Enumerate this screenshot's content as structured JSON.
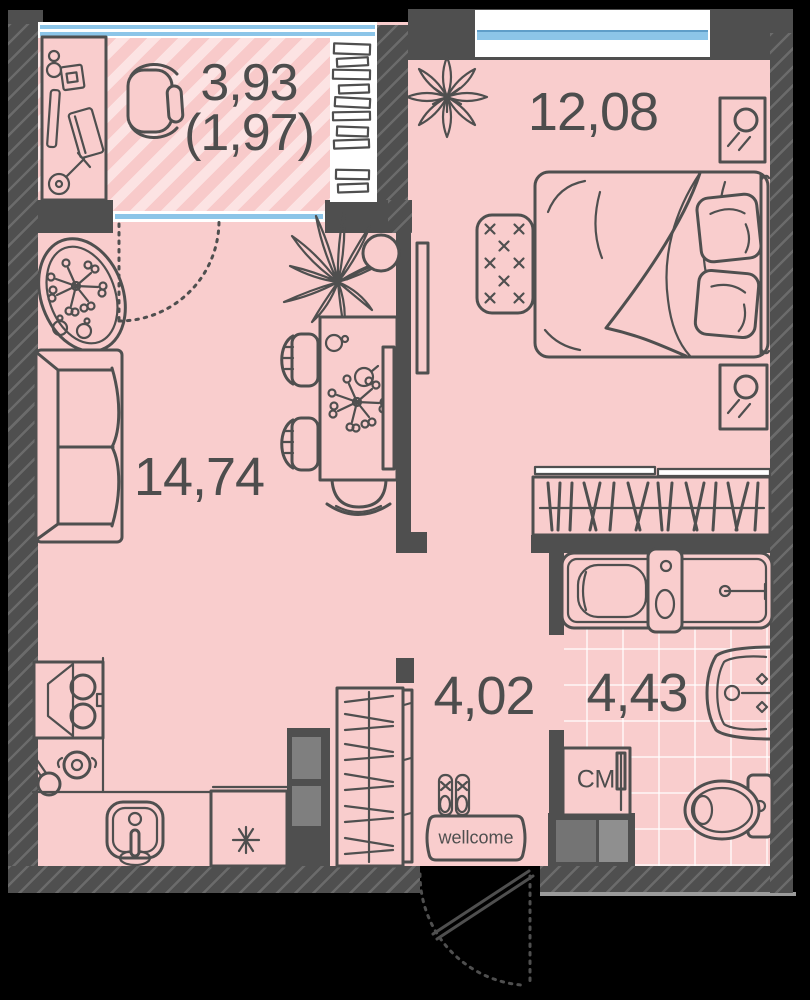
{
  "title": "one-room apartment floor plan",
  "colors": {
    "background": "#000000",
    "walls": "#4f4f4f",
    "floor": "#f9cdcd",
    "window_glass": "#8cc5e8",
    "tile_grout": "#ffffff",
    "label_text": "#4d4d4d"
  },
  "rooms": {
    "balcony": {
      "area": "3,93",
      "area_secondary": "(1,97)"
    },
    "bedroom": {
      "area": "12,08"
    },
    "living_room": {
      "area": "14,74"
    },
    "hallway": {
      "area": "4,02"
    },
    "bathroom": {
      "area": "4,43"
    }
  },
  "objects": {
    "washing_machine": "СМ",
    "doormat": "wellcome"
  },
  "icons": {
    "balcony": [
      "desk-icon",
      "office-chair-icon",
      "bookshelf-icon"
    ],
    "living_room": [
      "oval-rug-icon",
      "sofa-icon",
      "dining-table-icon",
      "chair-icon",
      "stool-icon",
      "palm-plant-icon",
      "tv-icon"
    ],
    "kitchen": [
      "stove-icon",
      "cooker-hood-icon",
      "pot-icon",
      "pan-icon",
      "sink-icon",
      "fridge-icon"
    ],
    "bedroom": [
      "star-plant-icon",
      "bed-icon",
      "pillow-icon",
      "rug-icon",
      "nightstand-icon",
      "wardrobe-icon"
    ],
    "bathroom": [
      "bathtub-icon",
      "washbasin-icon",
      "toilet-icon",
      "washing-machine-icon"
    ],
    "hallway": [
      "wardrobe-icon",
      "slippers-icon",
      "doormat-icon",
      "entrance-door-icon"
    ]
  }
}
